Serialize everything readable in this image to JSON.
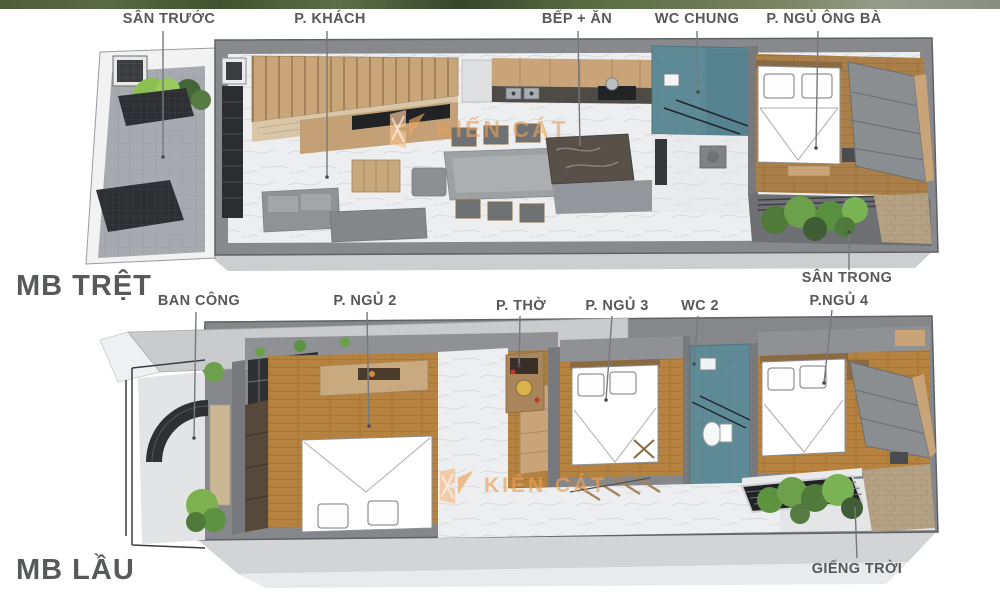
{
  "floor1": {
    "title": "MB TRỆT",
    "labels": {
      "san_truoc": "SÂN TRƯỚC",
      "p_khach": "P. KHÁCH",
      "bep_an": "BẾP + ĂN",
      "wc_chung": "WC CHUNG",
      "p_ngu_ong_ba": "P. NGỦ ÔNG BÀ",
      "san_trong": "SÂN TRONG"
    }
  },
  "floor2": {
    "title": "MB LẦU",
    "labels": {
      "ban_cong": "BAN CÔNG",
      "p_ngu_2": "P. NGỦ 2",
      "p_tho": "P. THỜ",
      "p_ngu_3": "P. NGỦ 3",
      "wc_2": "WC 2",
      "p_ngu_4": "P.NGỦ 4",
      "gieng_troi": "GIẾNG TRỜI"
    }
  },
  "watermark": {
    "text": "KIẾN CÁT"
  },
  "colors": {
    "label": "#58595b",
    "leader": "#77787b",
    "wall": "#85878a",
    "marble": "#edeef0",
    "wood_cabinet": "#c9a67a",
    "wood_floor": "#b5833f",
    "teal_tile": "#5f8b97",
    "plant_green": "#6da04a",
    "brick": "#b5a284",
    "watermark_orange": "#eda75f"
  }
}
